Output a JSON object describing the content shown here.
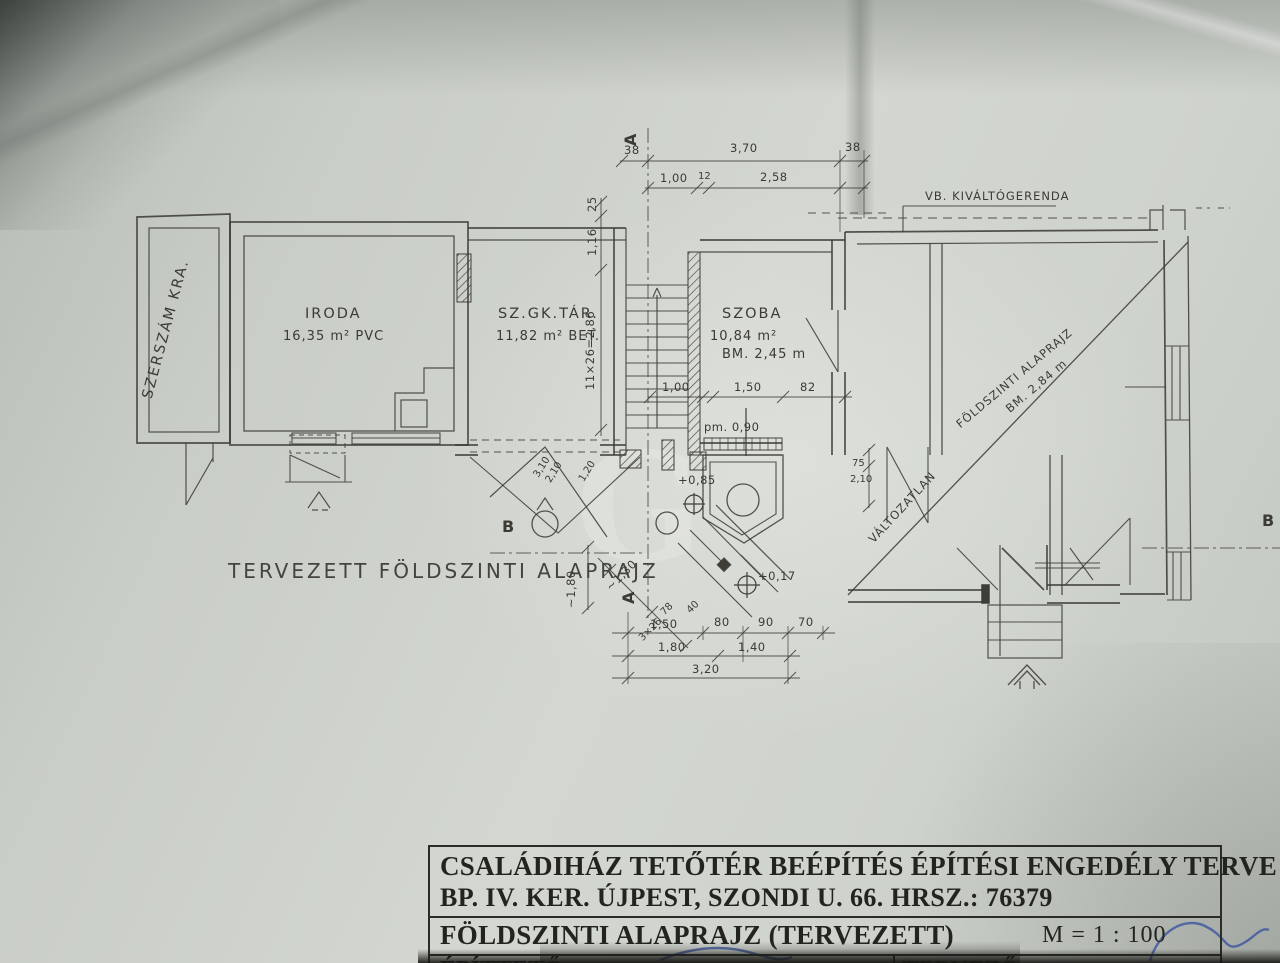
{
  "plan": {
    "rooms": {
      "szerszam": {
        "label": "SZERSZÁM KRA."
      },
      "iroda": {
        "name": "IRODA",
        "details": "16,35 m² PVC"
      },
      "szgktar": {
        "name": "SZ.GK.TÁR.",
        "details": "11,82 m² BET."
      },
      "szoba": {
        "name": "SZOBA",
        "details": "10,84 m²",
        "height": "BM. 2,45 m"
      }
    },
    "annotations": {
      "beam": "VB. KIVÁLTÓGERENDA",
      "unchanged": "VÁLTOZATLAN",
      "diag_title": "FÖLDSZINTI ALAPRAJZ",
      "diag_height": "BM. 2,84 m",
      "caption": "TERVEZETT FÖLDSZINTI ALAPRAJZ",
      "level_085": "+0,85",
      "level_017": "+0,17",
      "parapet": "pm. 0,90",
      "section_a": "A",
      "section_b": "B",
      "watermark": "G"
    },
    "dims": {
      "top1": [
        "38",
        "3,70",
        "38"
      ],
      "top2": [
        "1,00",
        "12",
        "2,58"
      ],
      "left": [
        "25",
        "1,16",
        "11×26=2,86"
      ],
      "mid": [
        "1,00",
        "1,50",
        "82"
      ],
      "right": [
        "75",
        "2,10"
      ],
      "entry": [
        "3,10",
        "2,10",
        "1,20"
      ],
      "v180": "~1,80",
      "diag": [
        "~1,30",
        "78",
        "3×26",
        "40"
      ],
      "b1": [
        "1,50",
        "80",
        "90",
        "70"
      ],
      "b2": [
        "1,80",
        "1,40"
      ],
      "b3": "3,20"
    }
  },
  "titleblock": {
    "line1": "CSALÁDIHÁZ TETŐTÉR BEÉPÍTÉS ÉPÍTÉSI ENGEDÉLY TERVE",
    "line2": "BP. IV. KER. ÚJPEST, SZONDI U. 66. HRSZ.: 76379",
    "line3": "FÖLDSZINTI ALAPRAJZ (TERVEZETT)",
    "scale": "M = 1 : 100",
    "client_label": "ÉPÍTTETŐ:",
    "designer_label": "TERVEZŐ:"
  }
}
